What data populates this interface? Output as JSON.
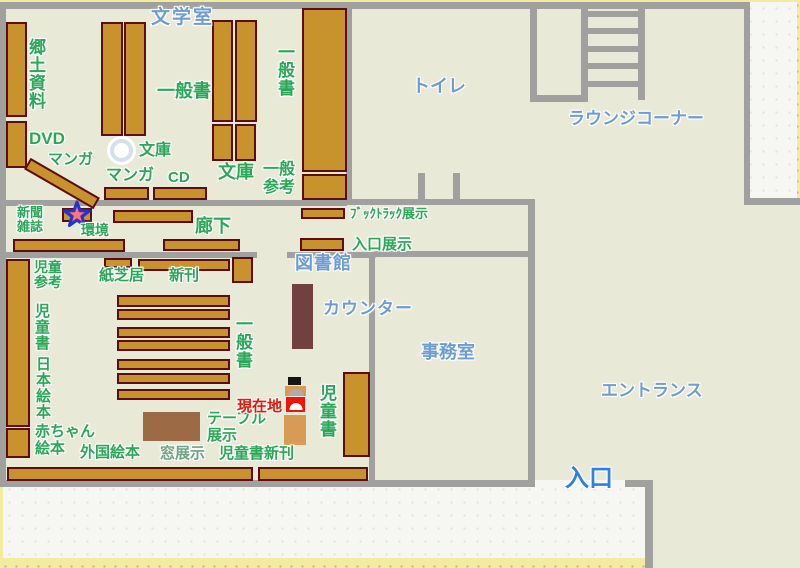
{
  "colors": {
    "floor_beige": "#e9e9d8",
    "wall_gray": "#a0a09e",
    "shelf_fill": "#c8932d",
    "shelf_border": "#5c0d0f",
    "green_label": "#2aa757",
    "blue_label": "#6f9dd0",
    "entrance_blue": "#2e7fe8",
    "current_location_red": "#ea1508",
    "counter_brown": "#714040",
    "table_brown": "#9c6b45",
    "paper_white": "#f6f6f2",
    "border_yellow": "#f1eca0"
  },
  "rooms": {
    "literature_room": "文学室",
    "toilet": "トイレ",
    "lounge_corner": "ラウンジコーナー",
    "library": "図書館",
    "office": "事務室",
    "entrance_hall": "エントランス",
    "entrance_door": "入口",
    "corridor": "廊下",
    "counter": "カウンター"
  },
  "shelves": {
    "kyodo_shiryo": "郷土資料",
    "dvd": "DVD",
    "manga_diagonal": "マンガ",
    "manga": "マンガ",
    "ippansho_center": "一般書",
    "bunko_pillar": "文庫",
    "cd": "CD",
    "bunko": "文庫",
    "ippan_sanko": "一般参考",
    "ippansho_right": "一般書",
    "shinbun_zasshi": "新聞雑誌",
    "kankyo": "環境",
    "booktruck_tenji": "ﾌﾞｯｸﾄﾗｯｸ展示",
    "iriguchi_tenji": "入口展示",
    "jido_sanko": "児童参考",
    "jidosho_left": "児童書",
    "nihon_ehon": "日本絵本",
    "akachan_ehon": "赤ちゃん絵本",
    "gaikoku_ehon": "外国絵本",
    "kamishibai": "紙芝居",
    "shinkan": "新刊",
    "ippansho_jido": "一般書",
    "mado_tenji": "窓展示",
    "jidosho_shinkan": "児童書新刊",
    "table_tenji": "テーブル展示",
    "jidosho_right": "児童書"
  },
  "markers": {
    "current_location": "現在地"
  }
}
